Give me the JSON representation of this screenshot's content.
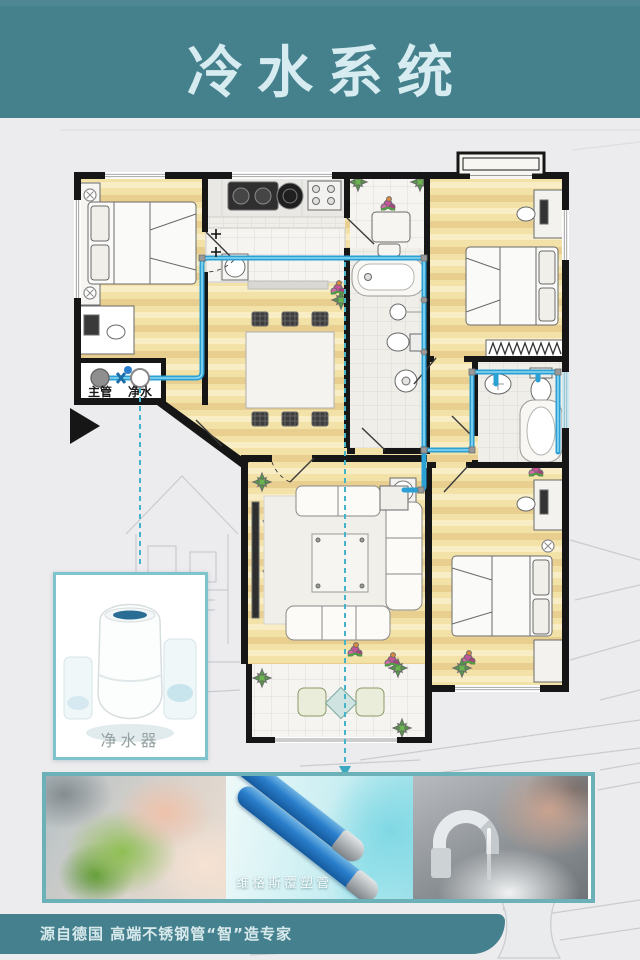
{
  "header": {
    "title": "冷水系统"
  },
  "floor_plan": {
    "main_pipe_label": "主管",
    "purified_water_label": "净水"
  },
  "purifier_card": {
    "caption": "净水器"
  },
  "photo_strip": {
    "pipe_caption": "维格斯覆塑管"
  },
  "footer": {
    "tagline": "源自德国  高端不锈钢管“智”造专家"
  },
  "colors": {
    "header_teal": "#45808d",
    "title_text": "#d6ecf0",
    "page_bg": "#ecebed",
    "wall": "#161616",
    "floor_yellow": "#f2e2a8",
    "pipe_blue": "#2aa0d4",
    "connector_teal": "#43b4c9",
    "card_border": "#7fc3cc",
    "strip_border": "#6cb0b8",
    "footer_bar": "#44808d"
  }
}
